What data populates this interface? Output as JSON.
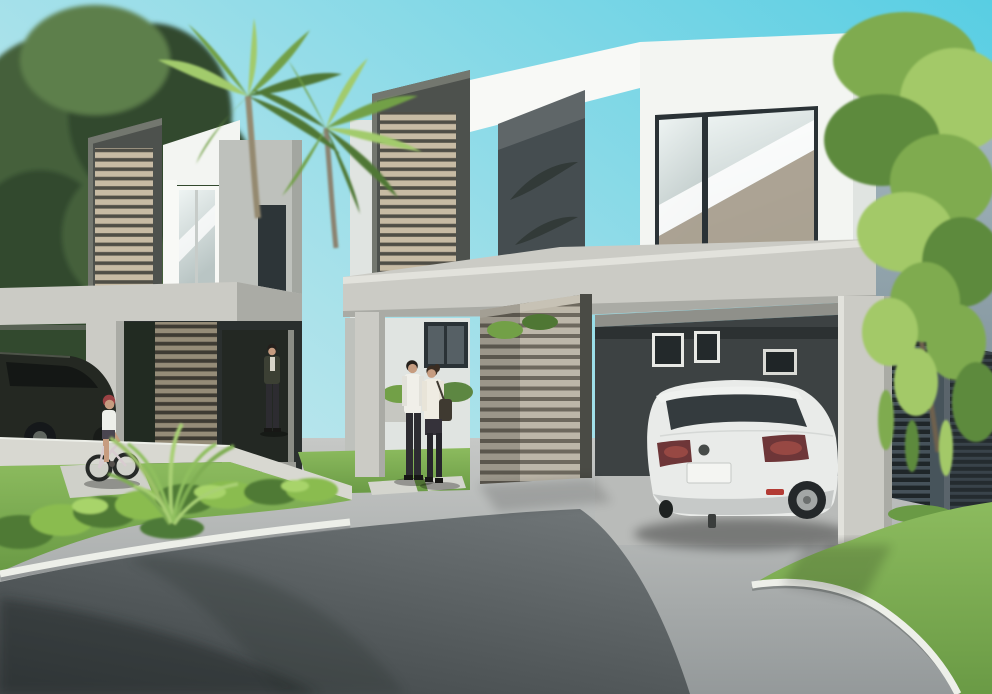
{
  "meta": {
    "type": "architectural-rendering",
    "width_px": 992,
    "height_px": 694
  },
  "scene": {
    "description": "Daytime 3D architectural rendering of modern two-story duplex houses with wooden louver screen boxes, open carports, a silver SUV parked under the right carport, a dark SUV at far left, a couple walking by the entry, a child riding a bicycle, palm trees, a cascading green tree, shrubs, lawns, a curved white curb, a concrete driveway and an asphalt street in the foreground.",
    "objects": [
      {
        "name": "sky",
        "label": "clear cyan sky"
      },
      {
        "name": "left-shade-tree",
        "label": "large green tree behind left house"
      },
      {
        "name": "palm-trees",
        "label": "two palm trees between the houses"
      },
      {
        "name": "willow-tree",
        "label": "cascading leafy tree at right"
      },
      {
        "name": "left-house",
        "label": "left unit with wooden louver box and carport"
      },
      {
        "name": "center-louver-box",
        "label": "center wooden louver screen box"
      },
      {
        "name": "right-house",
        "label": "right white unit with large glass window"
      },
      {
        "name": "carport-beam",
        "label": "long concrete carport beam"
      },
      {
        "name": "privacy-slat-screen",
        "label": "horizontal slat privacy screen"
      },
      {
        "name": "white-suv",
        "label": "silver SUV parked under right carport"
      },
      {
        "name": "dark-suv",
        "label": "dark SUV parked under left carport"
      },
      {
        "name": "entry-man",
        "label": "man standing at left entry"
      },
      {
        "name": "walking-couple",
        "label": "man and woman walking on walkway"
      },
      {
        "name": "child-on-bicycle",
        "label": "child riding a small bicycle"
      },
      {
        "name": "foreground-plant",
        "label": "arching palm plant on lawn"
      },
      {
        "name": "shrub-row",
        "label": "row of bright shrubs along curb"
      },
      {
        "name": "left-lawn",
        "label": "front lawn island at left"
      },
      {
        "name": "right-lawn",
        "label": "lawn at right with curved curb"
      },
      {
        "name": "driveway",
        "label": "light concrete driveway"
      },
      {
        "name": "street",
        "label": "asphalt street with tree shadows"
      },
      {
        "name": "white-curb",
        "label": "white painted curb edges"
      }
    ]
  },
  "palette": {
    "skyPale": "#d9eef0",
    "skyMid": "#9fdfe9",
    "skyCyan": "#58cee3",
    "treeDark": "#33492f",
    "treeMid": "#44603b",
    "treeLight": "#5d7f4b",
    "palmDark": "#4f7734",
    "palmMid": "#72a047",
    "palmLight": "#a2cb6c",
    "palmTrunk": "#94896f",
    "willowLight": "#a3c968",
    "willowMid": "#7fab4f",
    "willowDark": "#5d8a3c",
    "willowTrunk": "#6e614e",
    "wallWhite": "#f3f5f2",
    "wallBright": "#f8f9f6",
    "wallShade": "#e0e4e1",
    "wallGray": "#bec1bc",
    "wallGrayDark": "#a3a6a0",
    "concrete": "#cbcbc5",
    "concreteShade": "#aaaba5",
    "concreteBright": "#e2e2dc",
    "frameDark": "#4d514d",
    "frameLit": "#73776f",
    "louverSlat": "#c7bba4",
    "louverGap": "#4f4e46",
    "gSlat": "#958c78",
    "gGap": "#3e3b33",
    "screenSlat": "#bdb7a9",
    "screenGap": "#6e695e",
    "dkSlat": "#46525a",
    "dkGap": "#1f2629",
    "gateSlat": "#39434a",
    "gateGap": "#242b2f",
    "gateFrame": "#5a646b",
    "interiorDark": "#2a2f2e",
    "entryDark": "#232823",
    "foliageDeep": "#222b22",
    "bwallHi": "#a3b6be",
    "bwallLo": "#73848d",
    "bwallShade": "#5b6a72",
    "glassFrame": "#2a3236",
    "glassHi": "#eef4f3",
    "glassLo": "#b9c5c4",
    "glassTan": "#a89d8d",
    "winDark": "#2d3538",
    "driveLight": "#c6c8c6",
    "driveDark": "#94999a",
    "carportFloor": "#b9bbb9",
    "sidewalk": "#d8d8d1",
    "slabLight": "#d4d5ce",
    "roadLight": "#6e7476",
    "roadDark": "#3f4547",
    "grassLight": "#8cbb5e",
    "grassDark": "#6a9a45",
    "shrub": "#8abc50",
    "shrubDark": "#4f7a36",
    "shrubLight": "#a8d46a",
    "curb": "#edefe9",
    "suvBody": "#e9ebe9",
    "suvTrim": "#eff1ef",
    "suvShade": "#c6c9c8",
    "suvGlass": "#343b3e",
    "tailDark": "#6e3638",
    "tailLit": "#a14e46",
    "reflectorRed": "#b33b34",
    "tire": "#24282a",
    "rim": "#a3a7a6",
    "hubCap": "#6b6f6e",
    "plate": "#f4f5f2",
    "dsuvBody": "#242822",
    "dsuvGlass": "#141715",
    "dsuvHi": "#4d5348",
    "skin": "#c69c80",
    "hairDark": "#241f1b",
    "hairBrown": "#3a2d22",
    "shirtWhite": "#f0efe9",
    "shirtShade": "#e2e1da",
    "jacket": "#3c4034",
    "jacketShirt": "#d8d5c9",
    "pantsDark": "#2d2c31",
    "legsDark": "#26252b",
    "helmet": "#9c4244",
    "bag": "#3f3a31",
    "bikeFrame": "#d8ccd0",
    "shorts": "#4a4550",
    "shoeDark": "#171715"
  }
}
